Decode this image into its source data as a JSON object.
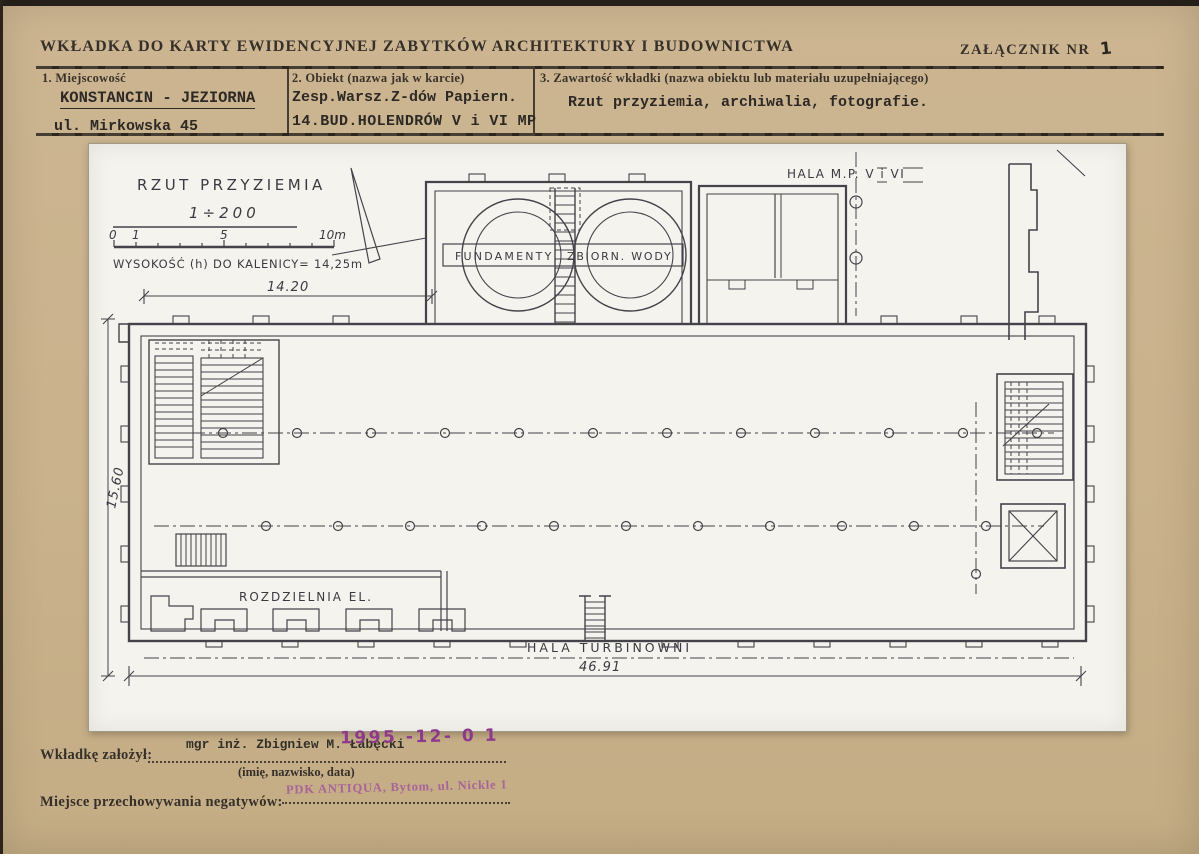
{
  "header": {
    "title": "WKŁADKA DO KARTY EWIDENCYJNEJ ZABYTKÓW ARCHITEKTURY I BUDOWNICTWA",
    "attachment_label": "ZAŁĄCZNIK NR",
    "attachment_number": "1"
  },
  "form": {
    "field1": {
      "label": "1. Miejscowość",
      "line1": "KONSTANCIN - JEZIORNA",
      "line2": "ul. Mirkowska 45"
    },
    "field2": {
      "label": "2. Obiekt (nazwa jak w karcie)",
      "line1": "Zesp.Warsz.Z-dów Papiern.",
      "line2": "14.BUD.HOLENDRÓW V i VI MP"
    },
    "field3": {
      "label": "3. Zawartość wkładki (nazwa obiektu lub materiału uzupełniającego)",
      "line1": "Rzut przyziemia, archiwalia, fotografie."
    }
  },
  "plan": {
    "title": "RZUT PRZYZIEMIA",
    "scale": "1÷200",
    "scale_ticks": [
      "0",
      "1",
      "5",
      "10m"
    ],
    "height_note": "WYSOKOŚĆ (h) DO KALENICY= 14,25m",
    "dim_top": "14.20",
    "dim_bottom": "46.91",
    "dim_left": "15.60",
    "hala_mp": "HALA M.P. V i VI",
    "fundamenty": "FUNDAMENTY",
    "zbiorn_wody": "ZBIORN. WODY",
    "rozdzielnia": "ROZDZIELNIA EL.",
    "hala_turbinowni": "HALA TURBINOWNI"
  },
  "footer": {
    "founder_label": "Wkładkę założył:",
    "founder_name": "mgr inż. Zbigniew M. Łabęcki",
    "date_stamp": "1995 -12- 0 1",
    "caption": "(imię, nazwisko, data)",
    "negatives_label": "Miejsce przechowywania negatywów:",
    "archive_stamp": "PDK ANTIQUA, Bytom, ul. Nickle 1"
  },
  "colors": {
    "paper": "#c9b28c",
    "sheet": "#f4f3ee",
    "ink": "#36302a",
    "drawing": "#45434a",
    "stamp_purple": "#9b3f95"
  }
}
